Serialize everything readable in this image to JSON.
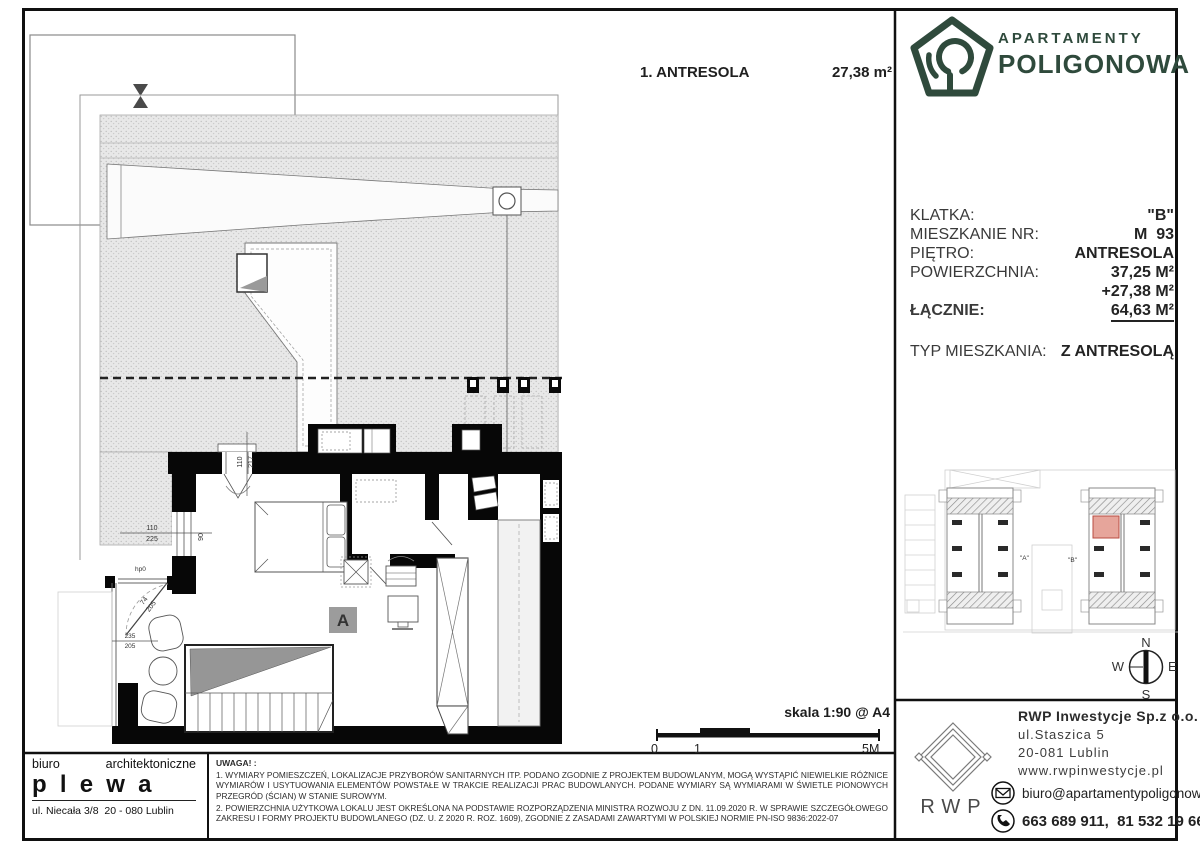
{
  "title": {
    "room_label": "1. ANTRESOLA",
    "room_area": "27,38 m²"
  },
  "brand": {
    "line1": "APARTAMENTY",
    "line2": "POLIGONOWA",
    "green": "#2f4a3c"
  },
  "info": {
    "klatka_label": "KLATKA:",
    "klatka_value": "\"B\"",
    "nr_label": "MIESZKANIE NR:",
    "nr_value": "M  93",
    "pietro_label": "PIĘTRO:",
    "pietro_value": "ANTRESOLA",
    "pow_label": "POWIERZCHNIA:",
    "pow_value1": "37,25 M²",
    "pow_value2": "+27,38 M²",
    "lacznie_label": "ŁĄCZNIE:",
    "lacznie_value": "64,63 M²",
    "typ_label": "TYP MIESZKANIA:",
    "typ_value": "Z ANTRESOLĄ"
  },
  "plan": {
    "unit_label": "A",
    "dim_win_w": "110",
    "dim_win_h": "225",
    "dim_win_hp": "90",
    "dim_hp": "hp0",
    "dim_door_w": "74",
    "dim_door_h": "205",
    "dim_low_w": "235",
    "dim_low_h": "205",
    "dim_sky_w": "110",
    "dim_sky_h": "217"
  },
  "site": {
    "a": "\"A\"",
    "b": "\"B\"",
    "highlight_color": "#e6a59b"
  },
  "compass": {
    "n": "N",
    "e": "E",
    "s": "S",
    "w": "W"
  },
  "scalebar": {
    "label": "skala 1:90 @ A4",
    "t0": "0",
    "t1": "1",
    "t5": "5M"
  },
  "architect": {
    "word1": "biuro",
    "word2": "architektoniczne",
    "name": "plewa",
    "address": "ul. Niecała 3/8  20 - 080 Lublin"
  },
  "notes": {
    "heading": "UWAGA! :",
    "note1": "1. WYMIARY POMIESZCZEŃ, LOKALIZACJE PRZYBORÓW SANITARNYCH ITP. PODANO ZGODNIE Z PROJEKTEM BUDOWLANYM, MOGĄ WYSTĄPIĆ NIEWIELKIE RÓŻNICE WYMIARÓW I USYTUOWANIA ELEMENTÓW POWSTAŁE W TRAKCIE REALIZACJI PRAC BUDOWLANYCH. PODANE WYMIARY SĄ WYMIARAMI W ŚWIETLE PIONOWYCH PRZEGRÓD (ŚCIAN) W STANIE SUROWYM.",
    "note2": "2. POWIERZCHNIA UŻYTKOWA LOKALU JEST OKREŚLONA NA PODSTAWIE ROZPORZĄDZENIA MINISTRA ROZWOJU Z DN. 11.09.2020 R. W SPRAWIE SZCZEGÓŁOWEGO ZAKRESU I FORMY PROJEKTU BUDOWLANEGO (DZ. U. Z 2020 R. ROZ. 1609), ZGODNIE Z ZASADAMI ZAWARTYMI W POLSKIEJ NORMIE PN-ISO 9836:2022-07"
  },
  "developer": {
    "name": "RWP Inwestycje Sp.z o.o.",
    "addr1": "ul.Staszica 5",
    "addr2": "20-081 Lublin",
    "web": "www.rwpinwestycje.pl",
    "email": "biuro@apartamentypoligonowa.pl",
    "phones": "663 689 911,  81 532 19 66",
    "mark": "RWP"
  }
}
